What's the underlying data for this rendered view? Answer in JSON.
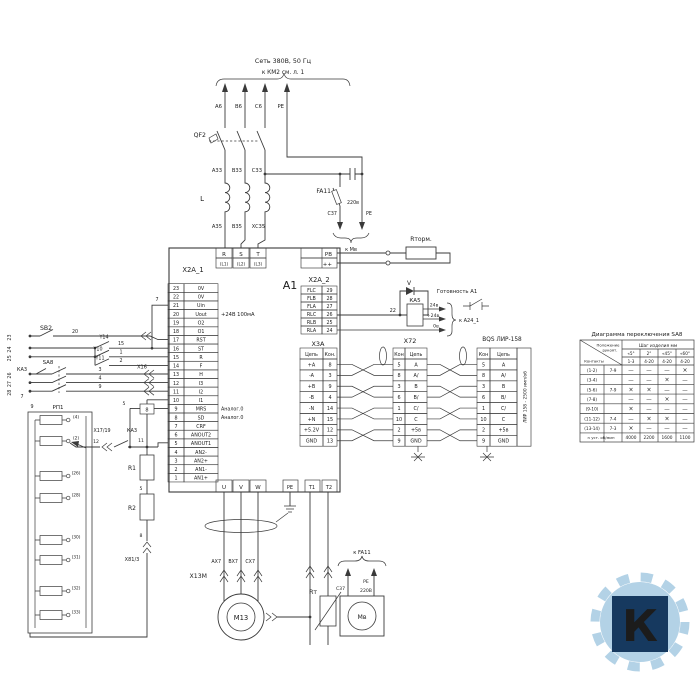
{
  "drawing": {
    "net": {
      "line1": "Сеть 380В, 50 Гц",
      "line2": "к КМ2 см. л. 1",
      "wires": [
        "А6",
        "В6",
        "С6",
        "PE"
      ],
      "breaker": "QF2",
      "wires33": [
        "А33",
        "В33",
        "С33"
      ],
      "inductor": "L",
      "wires35": [
        "А35",
        "В35",
        "ХС35"
      ]
    },
    "fa11": {
      "name": "FA11",
      "voltage": "220в",
      "c37": "С37",
      "pe": "PE",
      "dest": "к Мв"
    },
    "brake": {
      "name": "Rторм."
    },
    "a1": {
      "name": "А1",
      "top_terms": [
        [
          "R",
          "(L1)"
        ],
        [
          "S",
          "(L2)"
        ],
        [
          "T",
          "(L3)"
        ]
      ],
      "pb": "PB",
      "plus": "++",
      "x2a1": {
        "name": "X2A_1",
        "annot24": "+24В 100мА",
        "annot_analog": "Аналог.0",
        "rows": [
          [
            23,
            "0V"
          ],
          [
            22,
            "0V"
          ],
          [
            21,
            "Uin"
          ],
          [
            20,
            "Uout"
          ],
          [
            19,
            "O2"
          ],
          [
            18,
            "O1"
          ],
          [
            17,
            "RST"
          ],
          [
            16,
            "ST"
          ],
          [
            15,
            "R"
          ],
          [
            14,
            "F"
          ],
          [
            13,
            "H"
          ],
          [
            12,
            "I3"
          ],
          [
            11,
            "I2"
          ],
          [
            10,
            "I1"
          ],
          [
            9,
            "MRS"
          ],
          [
            8,
            "SD"
          ],
          [
            7,
            "CRF"
          ],
          [
            6,
            "ANOUT2"
          ],
          [
            5,
            "ANOUT1"
          ],
          [
            4,
            "AN2-"
          ],
          [
            3,
            "AN2+"
          ],
          [
            2,
            "AN1-"
          ],
          [
            1,
            "AN1+"
          ]
        ]
      },
      "x2a2": {
        "name": "X2A_2",
        "rows": [
          [
            "FLC",
            "29"
          ],
          [
            "FLB",
            "28"
          ],
          [
            "FLA",
            "27"
          ],
          [
            "RLC",
            "26"
          ],
          [
            "RLB",
            "25"
          ],
          [
            "RLA",
            "24"
          ]
        ]
      },
      "x3a": {
        "name": "X3A",
        "h1": "Цепь",
        "h2": "Кон.",
        "rows": [
          [
            "+A",
            "8"
          ],
          [
            "-A",
            "3"
          ],
          [
            "+B",
            "9"
          ],
          [
            "-B",
            "4"
          ],
          [
            "-N",
            "14"
          ],
          [
            "+N",
            "15"
          ],
          [
            "+5.2V",
            "12"
          ],
          [
            "GND",
            "13"
          ]
        ]
      },
      "bottom_terms": [
        "U",
        "V",
        "W"
      ],
      "pe": "PE",
      "t1": "T1",
      "t2": "T2"
    },
    "ka5": {
      "name": "КА5",
      "diode": "V",
      "wire22": "22",
      "v24": "24в",
      "v24p": "+24в",
      "v0": "0в",
      "ready": "Готовность А1",
      "dest": "к А24_1"
    },
    "x72": {
      "name": "X72",
      "h1": "Кон",
      "h2": "Цепь",
      "rows": [
        [
          "5",
          "A"
        ],
        [
          "8",
          "A/"
        ],
        [
          "3",
          "B"
        ],
        [
          "6",
          "B/"
        ],
        [
          "1",
          "C/"
        ],
        [
          "10",
          "C"
        ],
        [
          "2",
          "+5в"
        ],
        [
          "9",
          "GND"
        ]
      ]
    },
    "encoder": {
      "title": "BQS ЛИР-158",
      "h1": "Кон",
      "h2": "Цепь",
      "rows": [
        [
          "5",
          "A"
        ],
        [
          "8",
          "A/"
        ],
        [
          "3",
          "B"
        ],
        [
          "6",
          "B/"
        ],
        [
          "1",
          "C/"
        ],
        [
          "10",
          "C"
        ],
        [
          "2",
          "+5в"
        ],
        [
          "9",
          "GND"
        ]
      ],
      "side": "ЛИР 158 - 2500 имп/об"
    },
    "sa8": {
      "title": "Диаграмма переключения SA8",
      "hdr_top1": "Положение",
      "hdr_top2": "рукоят.",
      "hdr_bottom": "Контакты",
      "hdr_right": "Шаг изделия мм",
      "cols": [
        "«5°",
        "2°",
        "«45°",
        "«60°"
      ],
      "ranges": [
        "1-3",
        "4-20",
        "4-20",
        "4-20"
      ],
      "rows": [
        {
          "c": "(1-2)",
          "p": "7-9",
          "m": [
            "—",
            "—",
            "—",
            "×"
          ]
        },
        {
          "c": "(3-4)",
          "p": "",
          "m": [
            "—",
            "—",
            "×",
            "—"
          ]
        },
        {
          "c": "(5-6)",
          "p": "7-9",
          "m": [
            "×",
            "×",
            "—",
            "—"
          ]
        },
        {
          "c": "(7-8)",
          "p": "",
          "m": [
            "—",
            "—",
            "×",
            "—"
          ]
        },
        {
          "c": "(9-10)",
          "p": "",
          "m": [
            "×",
            "—",
            "—",
            "—"
          ]
        },
        {
          "c": "(11-12)",
          "p": "7-4",
          "m": [
            "—",
            "×",
            "×",
            "—"
          ]
        },
        {
          "c": "(13-14)",
          "p": "7-3",
          "m": [
            "×",
            "—",
            "—",
            "—"
          ]
        }
      ],
      "last_row": {
        "label": "n уст. об/мин",
        "vals": [
          "4000",
          "2200",
          "1600",
          "1100"
        ]
      }
    },
    "left": {
      "sb2": "S­B2",
      "w20": "20",
      "w7": "7",
      "y14": "Y14",
      "w15": "15",
      "y10": "Y10",
      "w1": "1",
      "y11": "Y11",
      "w2": "2",
      "ka3": "КА3",
      "sa8": "SA8",
      "w3": "3",
      "w4": "4",
      "w9": "9",
      "x16": "X16",
      "rails": [
        "23",
        "24",
        "25",
        "26",
        "27",
        "28"
      ],
      "w7b": "7",
      "w9b": "9",
      "rp1": "РП1",
      "terms": [
        "(4)",
        "(2)",
        "(26)",
        "(28)",
        "(30)",
        "(31)",
        "(32)",
        "(33)"
      ],
      "x17": "X17/19",
      "ka3b": "КА3",
      "w12": "12",
      "w11": "11",
      "w5": "5",
      "box8": "8",
      "w5b": "5",
      "w8": "8",
      "r1": "R1",
      "r2": "R2",
      "x81": "X81/3"
    },
    "motor": {
      "x13m": "X13M",
      "wires": [
        "АХ7",
        "ВХ7",
        "СХ7"
      ],
      "name": "М13",
      "rt": "Rт",
      "fan": "Мв",
      "fan_sup": "220В",
      "fan_c37": "С37",
      "fan_pe": "PE",
      "dest": "к FA11"
    },
    "logo": {
      "letter": "К"
    }
  }
}
